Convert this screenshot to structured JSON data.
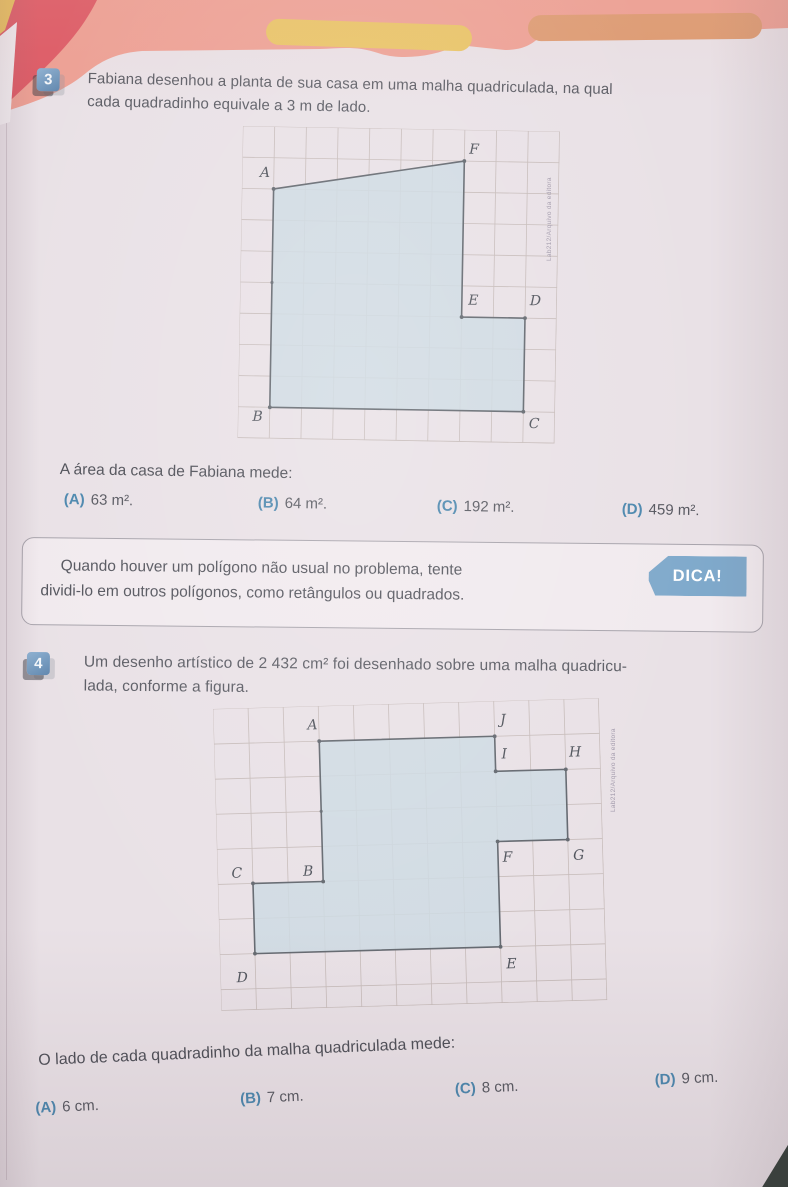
{
  "page": {
    "credit": "Lab212/Arquivo da editora"
  },
  "exercise3": {
    "number": "3",
    "text_line1": "Fabiana desenhou a planta de sua casa em uma malha quadriculada, na qual",
    "text_line2": "cada quadradinho equivale a 3 m de lado.",
    "question": "A área da casa de Fabiana mede:",
    "options": [
      {
        "letter": "(A)",
        "value": "63 m²."
      },
      {
        "letter": "(B)",
        "value": "64 m²."
      },
      {
        "letter": "(C)",
        "value": "192 m²."
      },
      {
        "letter": "(D)",
        "value": "459 m²."
      }
    ]
  },
  "tip_box": {
    "label": "DICA!",
    "line1": "Quando houver um polígono não usual no problema, tente",
    "line2": "dividi-lo em outros polígonos, como retângulos ou quadrados."
  },
  "exercise4": {
    "number": "4",
    "text_line1": "Um desenho artístico de 2 432 cm² foi desenhado sobre uma malha quadricu-",
    "text_line2": "lada, conforme a figura.",
    "question": "O lado de cada quadradinho da malha quadriculada mede:",
    "options": [
      {
        "letter": "(A)",
        "value": "6 cm."
      },
      {
        "letter": "(B)",
        "value": "7 cm."
      },
      {
        "letter": "(C)",
        "value": "8 cm."
      },
      {
        "letter": "(D)",
        "value": "9 cm."
      }
    ]
  },
  "figure_style": {
    "grid_line_color": "#c6bbb9",
    "polygon_fill": "#cdd9e2",
    "polygon_fill_opacity": 0.85,
    "polygon_stroke": "#62676e",
    "label_color": "#4e525a"
  },
  "figures": [
    {
      "target_id": "fig1-svg",
      "name": "planta-da-casa",
      "width": 317,
      "height": 312,
      "cols": 10,
      "rows": 10,
      "cell_w": 31.7,
      "cell_h": 31.2,
      "vertices": [
        {
          "label": "A",
          "x": 1,
          "y": 2,
          "lx": 0.72,
          "ly": 1.62
        },
        {
          "label": "F",
          "x": 7,
          "y": 1,
          "lx": 7.3,
          "ly": 0.76
        },
        {
          "label": "E",
          "x": 7,
          "y": 6,
          "lx": 7.36,
          "ly": 5.6
        },
        {
          "label": "D",
          "x": 9,
          "y": 6,
          "lx": 9.32,
          "ly": 5.58
        },
        {
          "label": "C",
          "x": 9,
          "y": 9,
          "lx": 9.35,
          "ly": 9.52
        },
        {
          "label": "B",
          "x": 1,
          "y": 9,
          "lx": 0.62,
          "ly": 9.44
        }
      ],
      "extra_dots": [
        [
          1,
          5
        ]
      ]
    },
    {
      "target_id": "fig2-svg",
      "name": "desenho-artistico",
      "width": 386,
      "height": 302,
      "cols": 11,
      "rows": 8.6,
      "cell_w": 35.1,
      "cell_h": 35.1,
      "vertices": [
        {
          "label": "A",
          "x": 3,
          "y": 1,
          "lx": 2.82,
          "ly": 0.66
        },
        {
          "label": "J",
          "x": 8,
          "y": 1,
          "lx": 8.25,
          "ly": 0.66
        },
        {
          "label": "I",
          "x": 8,
          "y": 2,
          "lx": 8.26,
          "ly": 1.64
        },
        {
          "label": "H",
          "x": 10,
          "y": 2,
          "lx": 10.28,
          "ly": 1.64
        },
        {
          "label": "G",
          "x": 10,
          "y": 4,
          "lx": 10.3,
          "ly": 4.58
        },
        {
          "label": "F",
          "x": 8,
          "y": 4,
          "lx": 8.27,
          "ly": 4.58
        },
        {
          "label": "E",
          "x": 8,
          "y": 7,
          "lx": 8.3,
          "ly": 7.62
        },
        {
          "label": "D",
          "x": 1,
          "y": 7,
          "lx": 0.62,
          "ly": 7.8
        },
        {
          "label": "C",
          "x": 1,
          "y": 5,
          "lx": 0.55,
          "ly": 4.82
        },
        {
          "label": "B",
          "x": 3,
          "y": 5,
          "lx": 2.58,
          "ly": 4.82
        }
      ],
      "extra_dots": [
        [
          3,
          3
        ]
      ]
    }
  ],
  "colors": {
    "page_bg": "#e9e1e6",
    "band_salmon": "#eda094",
    "band_crimson": "#dd5b66",
    "bar_yellow": "#e9c464",
    "bar_orange": "#dd9b72",
    "badge_blue": "#6f94b8",
    "tip_badge_blue": "#7fa9cb",
    "option_letter": "#4a86ad",
    "body_text": "#5a5b63"
  }
}
